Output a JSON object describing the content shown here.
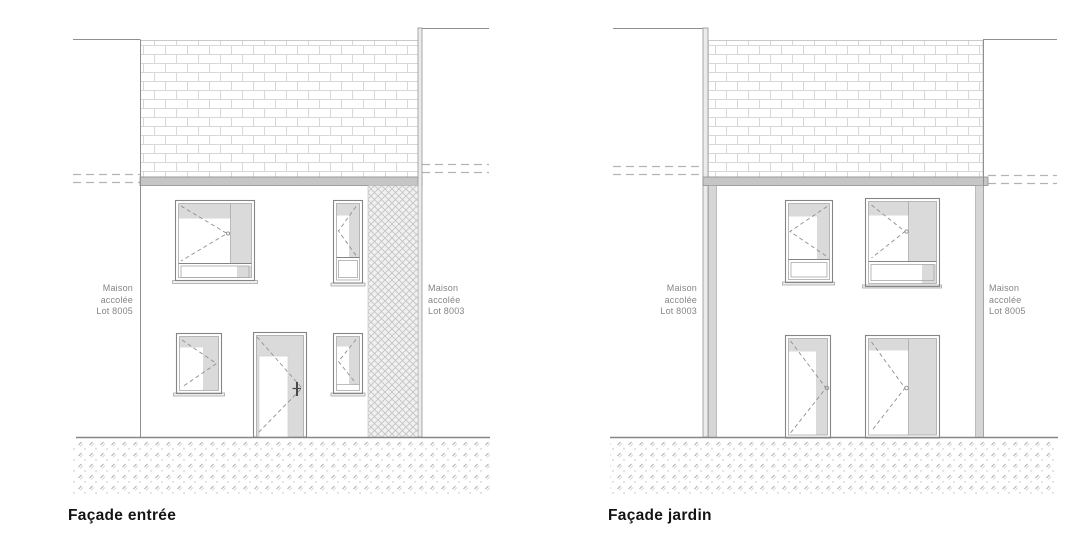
{
  "palette": {
    "line_gray": "#8f8f8f",
    "mortar_gray": "#d8d8d8",
    "slab_gray": "#c6c6c6",
    "shade_gray": "#dadada",
    "hatch_gray": "#c4c4c4",
    "label_gray": "#858585",
    "title_black": "#141414",
    "paper_white": "#ffffff"
  },
  "facades": [
    {
      "id": "entree",
      "title": "Façade entrée",
      "neighbor_left": {
        "label": "Maison\naccolée\nLot 8005"
      },
      "neighbor_right": {
        "label": "Maison\naccolée\nLot 8003"
      }
    },
    {
      "id": "jardin",
      "title": "Façade jardin",
      "neighbor_left": {
        "label": "Maison\naccolée\nLot 8003"
      },
      "neighbor_right": {
        "label": "Maison\naccolée\nLot 8005"
      }
    }
  ]
}
